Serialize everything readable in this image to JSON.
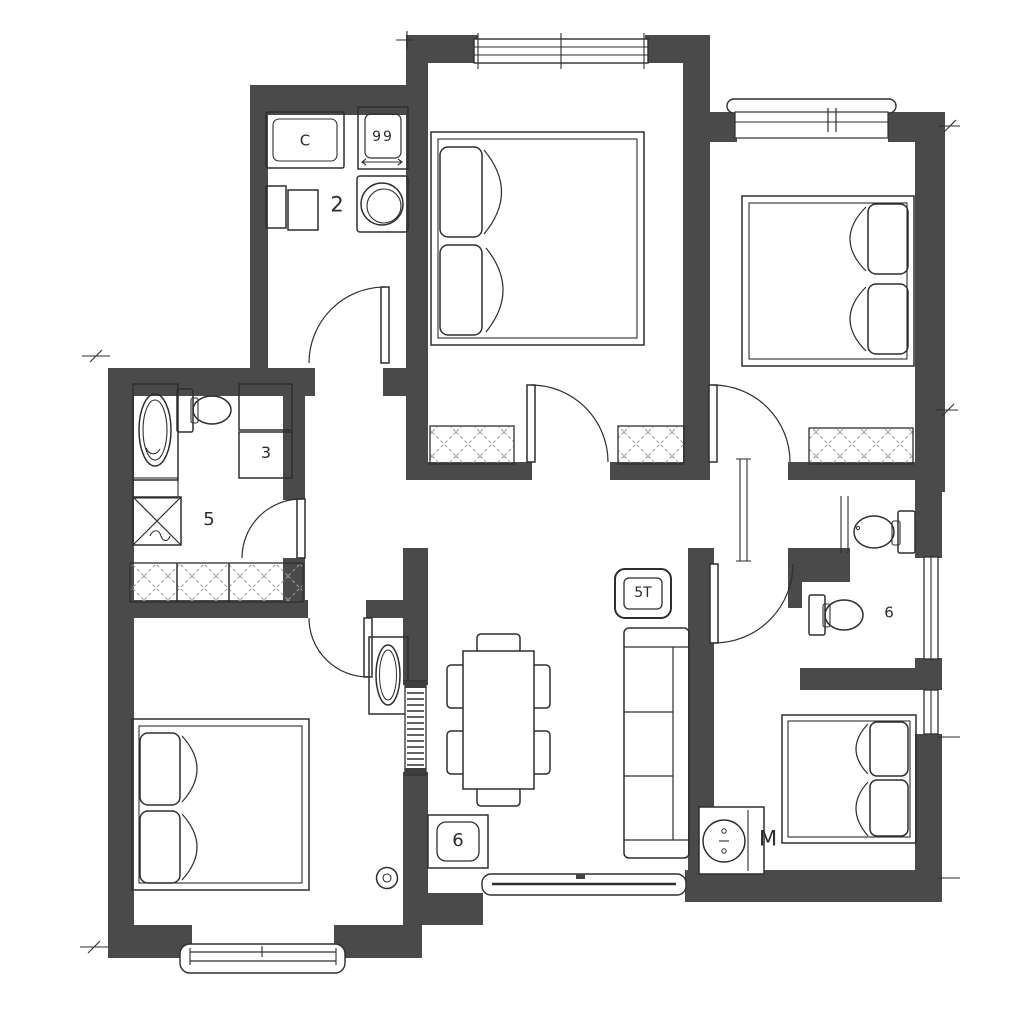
{
  "title": "Apartment floor plan",
  "colors": {
    "wall": "#4a4a4a",
    "line": "#2e2e2e",
    "hatch": "#9a9a9a",
    "floor": "#ffffff"
  },
  "labels": {
    "kitchen_room": "2",
    "kitchen_counter": "C",
    "stove_burners": "99",
    "bathroom_room": "5",
    "bathroom_shelf": "3",
    "tv_unit": "5T",
    "wc_room": "6",
    "entry_unit": "6",
    "washing_machine": "M"
  },
  "inventory": {
    "bedrooms": 4,
    "double_beds": 4,
    "wardrobes_hatched": 3,
    "toilets": 3,
    "windows": 6,
    "door_swings": 6,
    "dining_chairs": 6,
    "sofa_seats": 3
  }
}
